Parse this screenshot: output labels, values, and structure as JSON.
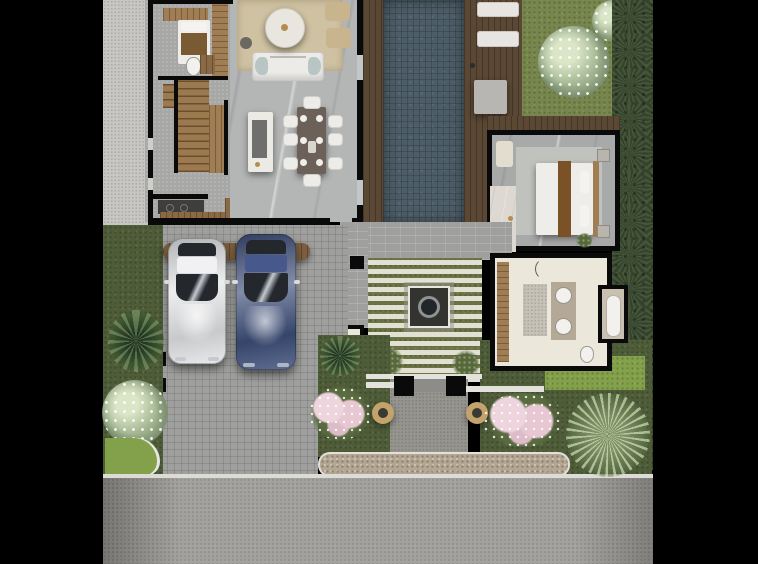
{
  "scene": {
    "type": "architectural-floor-plan-render",
    "view": "top-down",
    "canvas": {
      "width": 758,
      "height": 564
    },
    "inventory": {
      "indoor": [
        "living-room with rug, sofa, round coffee table, 2 armchairs",
        "dining-area with dark table and 8 white chairs",
        "kitchen-island with dark counter top",
        "kitchen-counter with cooktop",
        "staircase (timber treads)",
        "guest-room with single bed and wardrobe",
        "guest-wc with toilet and vanity",
        "entry-foyer with bench and console",
        "powder-room with toilet and basin",
        "master-bedroom with king bed, runner, 2 nightstands, armchair",
        "master-bathroom with double vanity, bathtub, toilet"
      ],
      "outdoor": [
        "lap-pool with timber deck both sides",
        "2 sun-loungers on deck",
        "lawn with white frangipani tree",
        "palm hedge along right boundary",
        "paved courtyard with central square water feature",
        "entry gate with 2 black posts and 2 round planters",
        "pink flowering shrubs both sides of entry",
        "white flowering tree and palm in front-left garden",
        "large fan palm at front-right",
        "paver driveway with timber pergola over 2 parked cars",
        "pebbled sidewalk strip",
        "asphalt road along bottom"
      ],
      "vehicles": [
        "white-suv",
        "blue-suv"
      ],
      "counts": {
        "dining_chairs": 8,
        "sun_loungers": 2,
        "cars": 2,
        "gate_posts": 2,
        "planters": 2,
        "bathroom_sinks": 2
      }
    }
  },
  "palette": {
    "background": "#000000",
    "sidePath": "#c7c6c2",
    "hallFloor": "#a7a7a5",
    "interiorFloor": "#b4b5b5",
    "rug": "#cfc2a2",
    "sofaWhite": "#edebe7",
    "coffeeTable": "#e9e6df",
    "sideTable": "#6b6862",
    "armchairTan": "#c8b58e",
    "islandWhite": "#eceae5",
    "islandTop": "#6f6f6d",
    "diningTable": "#6b6158",
    "chairWhite": "#edece8",
    "stairWood": "#9c7a50",
    "woodLight": "#a07d52",
    "woodMid": "#8a6a45",
    "deckWood": "#5a4734",
    "counterDark": "#3f3e3c",
    "applianceWhite": "#f0efec",
    "pillowWhite": "#f4f3f0",
    "blanketBrown": "#7a5a33",
    "wall": "#0a0a0a",
    "doorGap": "#cfcecb",
    "glassDoor": "#c2c7c9",
    "poolWater": "#4d5d68",
    "loungerWhite": "#e6e5e2",
    "paverStone": "#b8b6b2",
    "grass": "#77864d",
    "grassBright": "#83a04b",
    "grassDark": "#4e5c38",
    "palmDark": "#35432c",
    "courtyardGrass": "#6b7444",
    "pebbleDark": "#33332f",
    "waterDark": "#20262a",
    "fountainRim": "#e8e6df",
    "brick": "#9fa09e",
    "stone": "#96948e",
    "sidewalk": "#b3a794",
    "curb": "#dddbd6",
    "road": "#a3a19d",
    "bedroomFloor": "#a8aaa9",
    "bedRug": "#c0c2be",
    "bedWhite": "#eeede9",
    "runnerBrown": "#7a5226",
    "nightstand": "#b9b4ac",
    "armchairCream": "#e3ddd0",
    "marbleWhite": "#ddd9d2",
    "bathFloor": "#ece7db",
    "vanityStone": "#b4a896",
    "matGray": "#c5c1b6",
    "fixtureWhite": "#f2f1ed",
    "tubSurround": "#c9c0b2",
    "pergolaWood": "#7c5f3e",
    "carWhite": "#e4e5e7",
    "carBlue": "#3d4e79",
    "glassDark": "#24272c",
    "roofWhite": "#f1f1f3",
    "roofBlue": "#46588c",
    "planterTan": "#c2a36b",
    "planterCore": "#3a3a34",
    "porchWhite": "#e3e1db",
    "goldAccent": "#b48d4e",
    "mirrorGray": "#d9dadd"
  }
}
